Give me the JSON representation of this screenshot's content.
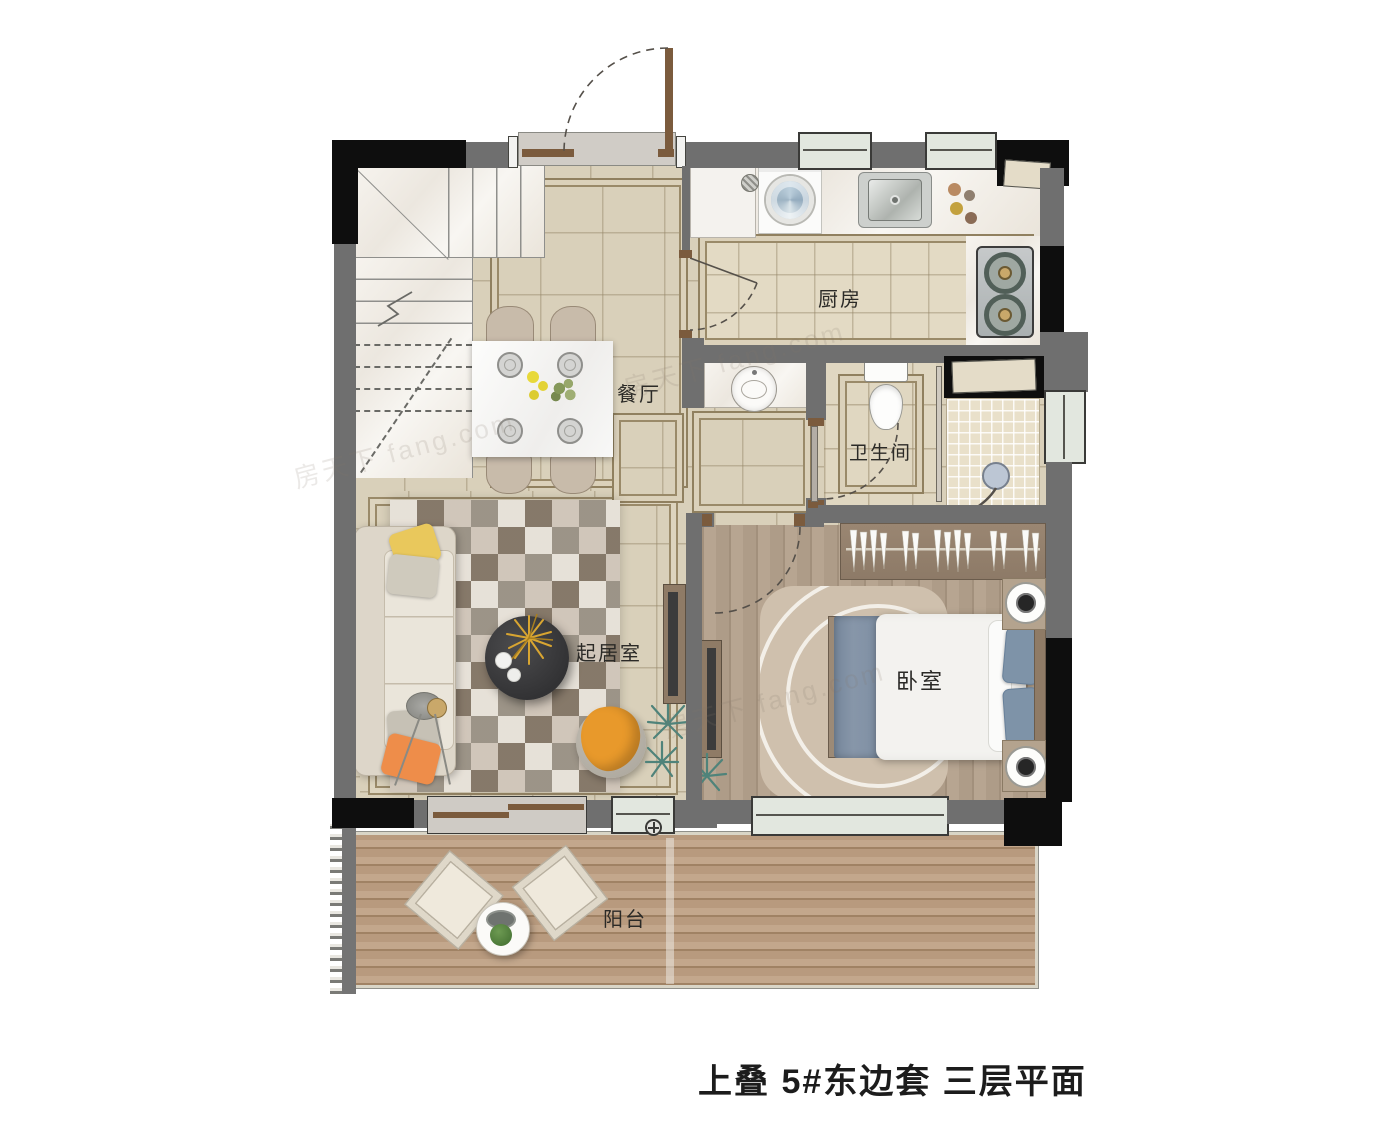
{
  "title": "上叠 5#东边套 三层平面",
  "watermark": "房天下 fang.com",
  "rooms": {
    "kitchen": {
      "label": "厨房"
    },
    "dining": {
      "label": "餐厅"
    },
    "bathroom": {
      "label": "卫生间"
    },
    "living_room": {
      "label": "起居室"
    },
    "bedroom": {
      "label": "卧室"
    },
    "balcony": {
      "label": "阳台"
    }
  },
  "palette": {
    "wall_grey": "#6f6f6f",
    "wall_black": "#0e0e0e",
    "tile_beige": "#d9d0ba",
    "tile_border": "#90805f",
    "bedroom_wood": "#b09c87",
    "deck_wood": "#bb9d81",
    "window_glass": "#e2e7df",
    "marble_counter": "#f4f1ea",
    "accent_orange": "#e8992b",
    "accent_yellow": "#e9c85c",
    "bed_blue": "#7e93a8",
    "plant_teal": "#4f837a",
    "gold_decor": "#d8a531",
    "label_text": "#2b2a27"
  }
}
